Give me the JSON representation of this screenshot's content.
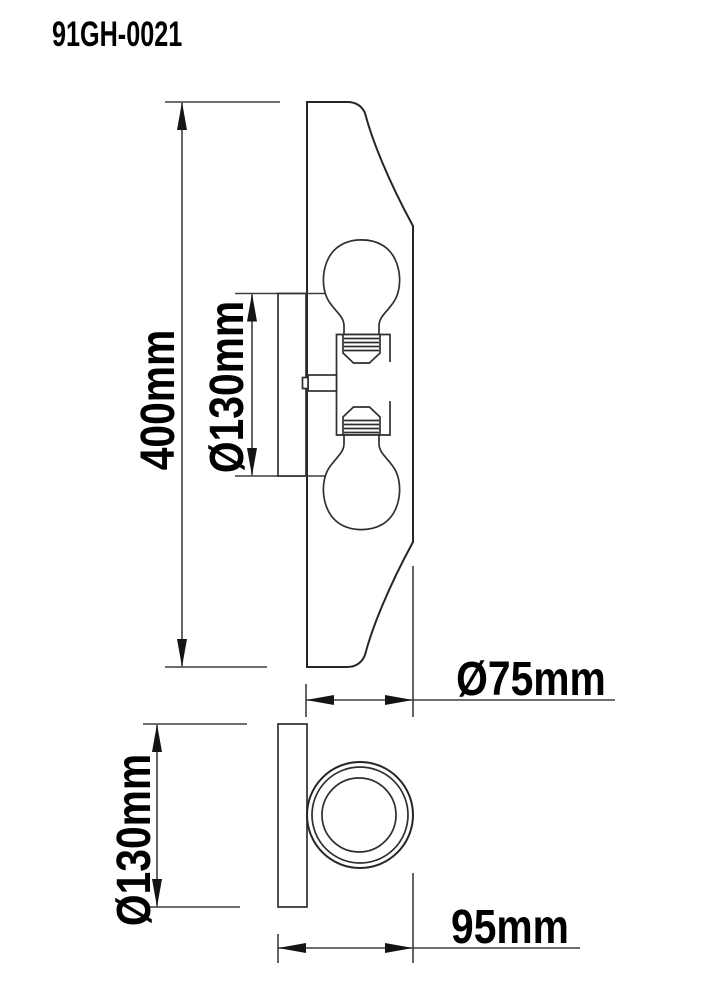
{
  "product_code": "91GH-0021",
  "front_view": {
    "length_label": "400mm",
    "canopy_diameter_label": "Ø130mm",
    "shade_diameter_label": "Ø75mm"
  },
  "side_view": {
    "backplate_diameter_label": "Ø130mm",
    "depth_label": "95mm"
  },
  "colors": {
    "background": "#ffffff",
    "line": "#2f2f2f",
    "dimension_line": "#3d3d3d",
    "text": "#000000"
  }
}
